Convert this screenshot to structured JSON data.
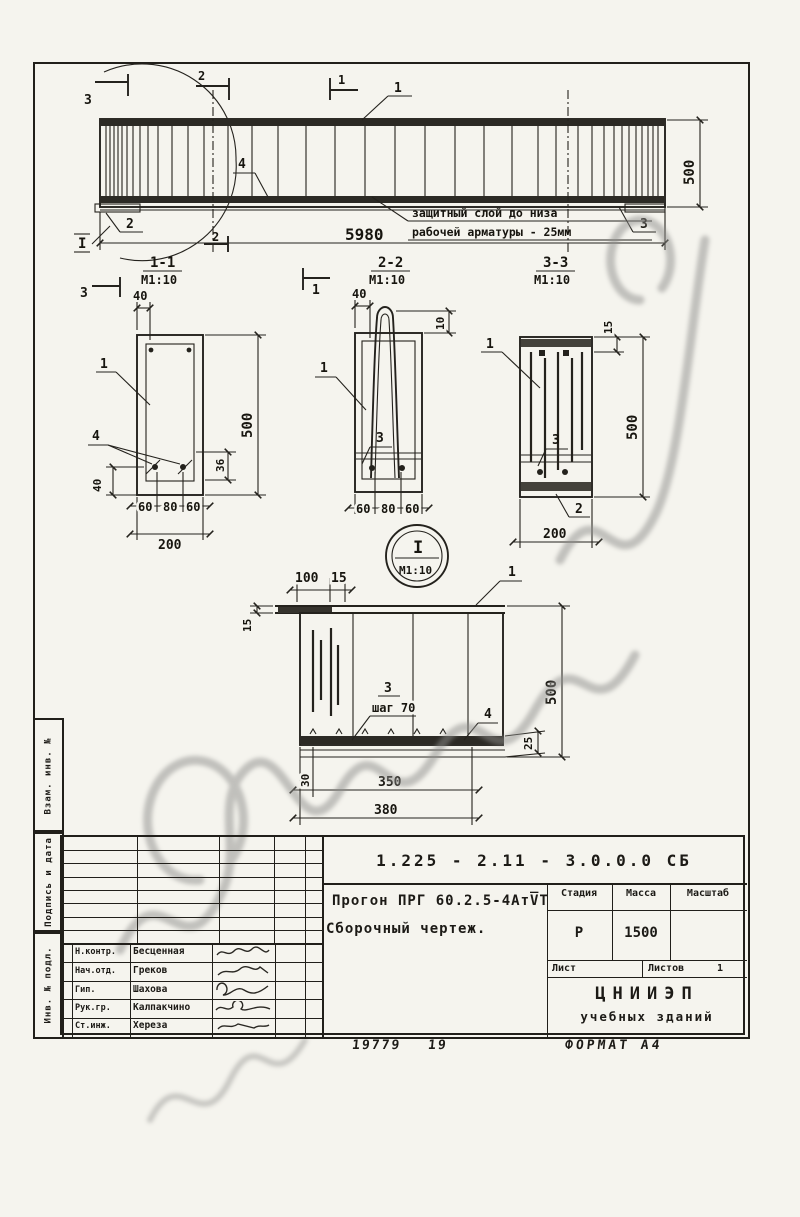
{
  "page": {
    "order_number": "19779",
    "sheet_number": "19",
    "format_label": "ФОРМАТ А4"
  },
  "margin_labels": {
    "vzam": "Взам. инв. №",
    "podpis": "Подпись и дата",
    "inv": "Инв. № подл."
  },
  "elevation": {
    "length": "5980",
    "height": "500",
    "note_line1": "защитный слой до низа",
    "note_line2": "рабочей арматуры - 25мм",
    "detail_ref": "I",
    "marks": {
      "m1": "1",
      "m2": "2",
      "m3": "3"
    },
    "callouts": {
      "c1": "1",
      "c2": "2",
      "c3": "3",
      "c4": "4"
    }
  },
  "section11": {
    "title": "1-1",
    "scale": "М1:10",
    "dim_top": "40",
    "dim_height": "500",
    "dim_36": "36",
    "dim_40": "40",
    "dim_b1": "60",
    "dim_b2": "80",
    "dim_b3": "60",
    "dim_width": "200",
    "callout1": "1",
    "callout4": "4"
  },
  "section22": {
    "title": "2-2",
    "scale": "М1:10",
    "dim_top": "40",
    "dim_10": "10",
    "dim_b1": "60",
    "dim_b2": "80",
    "dim_b3": "60",
    "callout1": "1",
    "callout3": "3"
  },
  "section33": {
    "title": "3-3",
    "scale": "М1:10",
    "dim_15": "15",
    "dim_height": "500",
    "dim_width": "200",
    "callout1": "1",
    "callout3": "3",
    "callout2": "2"
  },
  "detail": {
    "ref": "I",
    "scale": "М1:10",
    "dim_100": "100",
    "dim_15_top": "15",
    "dim_15_left": "15",
    "dim_height": "500",
    "dim_25": "25",
    "dim_30": "30",
    "dim_350": "350",
    "dim_380": "380",
    "step_note": "шаг 70",
    "callout1": "1",
    "callout3": "3",
    "callout4": "4"
  },
  "title_block": {
    "doc_code": "1.225 - 2.11 - 3.0.0.0 СБ",
    "product_name": "Прогон ПРГ 60.2.5-4АтV̅Т",
    "drawing_type": "Сборочный чертеж.",
    "stage_label": "Стадия",
    "stage_value": "Р",
    "mass_label": "Масса",
    "mass_value": "1500",
    "scale_label": "Масштаб",
    "scale_value": "",
    "sheet_label": "Лист",
    "sheets_label": "Листов",
    "sheets_value": "1",
    "org_name_line1": "ЦНИИЭП",
    "org_name_line2": "учебных зданий",
    "signatures": [
      {
        "role": "Н.контр.",
        "name": "Бесценная"
      },
      {
        "role": "Нач.отд.",
        "name": "Греков"
      },
      {
        "role": "Гип.",
        "name": "Шахова"
      },
      {
        "role": "Рук.гр.",
        "name": "Калпакчино"
      },
      {
        "role": "Ст.инж.",
        "name": "Хереза"
      }
    ]
  }
}
